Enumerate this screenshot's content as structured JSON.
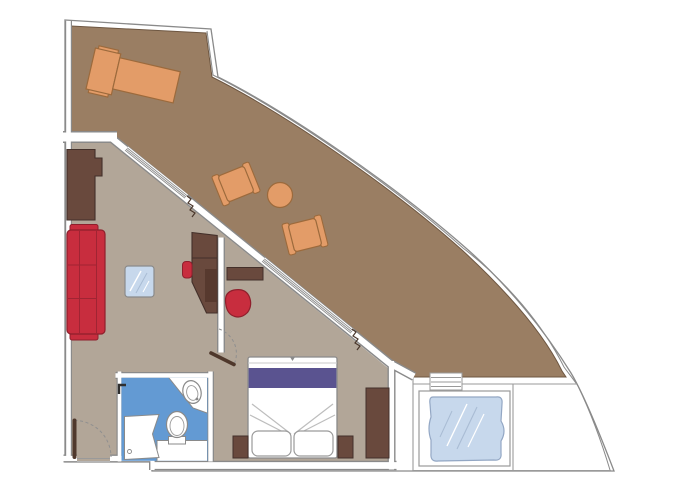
{
  "canvas": {
    "width": 680,
    "height": 491
  },
  "palette": {
    "page_background": "#ffffff",
    "wall_line": "#8a8a8a",
    "wall_fill": "#ffffff",
    "terrace_floor": "#9a7e63",
    "terrace_edge": "#6e5742",
    "interior_floor": "#b2a698",
    "bathroom_floor": "#639ad3",
    "wood_dark": "#69493d",
    "wood_dark_edge": "#43302a",
    "upholstery_red": "#c82d3e",
    "upholstery_red_edge": "#8f1f2c",
    "rattan_orange": "#e39c68",
    "rattan_orange_edge": "#9c6a3c",
    "glass_blue": "#c7d8ec",
    "glass_blue_edge": "#93a7c4",
    "bed_runner_purple": "#5a5390",
    "fixture_white": "#ffffff",
    "door_leaf_brown": "#4f382c",
    "curtain_line": "#4a372c"
  },
  "plan": {
    "type": "suite-floor-plan-with-curved-terrace",
    "rooms": [
      "terrace",
      "living-area",
      "bedroom",
      "bathroom",
      "entrance-corridor",
      "whirlpool-deck"
    ],
    "furniture": [
      "sun-lounger",
      "rattan-armchair",
      "rattan-armchair",
      "round-side-table",
      "sofa",
      "glass-coffee-table",
      "desk",
      "desk-chair",
      "tub-chair",
      "console-shelf",
      "double-bed",
      "pillow",
      "pillow",
      "nightstand",
      "nightstand",
      "wardrobe",
      "wardrobe",
      "toilet",
      "washbasin",
      "shower",
      "vanity-counter",
      "whirlpool-tub",
      "deck-steps",
      "sliding-glass-door",
      "sliding-glass-door",
      "curtain",
      "curtain",
      "entrance-door",
      "bedroom-door"
    ]
  }
}
